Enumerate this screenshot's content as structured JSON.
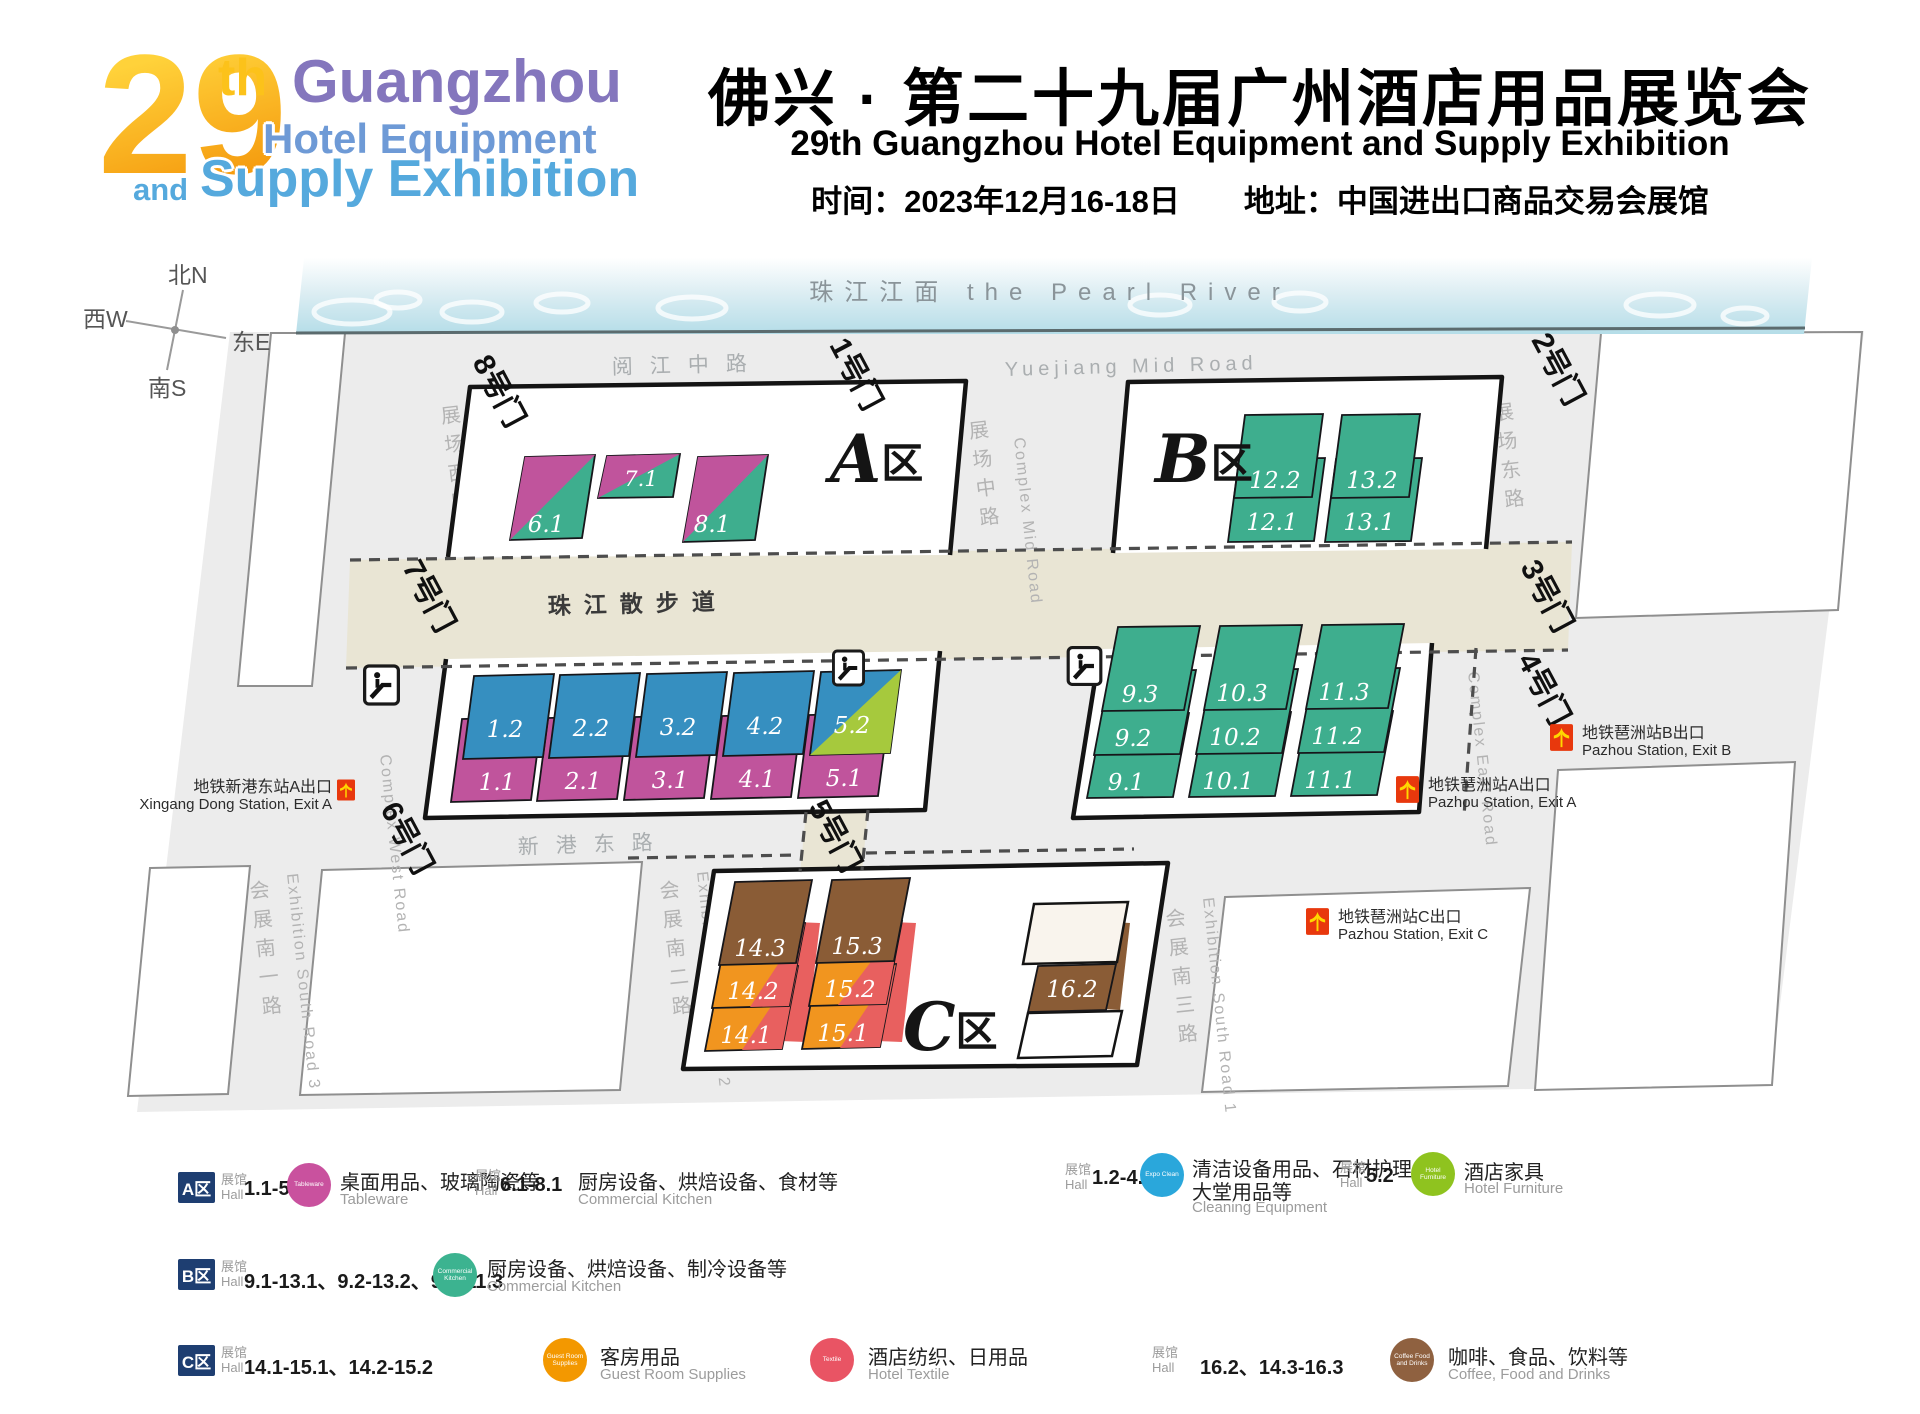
{
  "header": {
    "logo_29": "29",
    "logo_th": "th",
    "logo_l1": "Guangzhou",
    "logo_l2": "Hotel Equipment",
    "logo_and": "and",
    "logo_l3": "Supply Exhibition",
    "title_cn": "佛兴 · 第二十九届广州酒店用品展览会",
    "title_en": "29th Guangzhou Hotel Equipment and Supply Exhibition",
    "time_label": "时间：2023年12月16-18日",
    "addr_label": "地址：中国进出口商品交易会展馆"
  },
  "compass": {
    "n": "北N",
    "w": "西W",
    "e": "东E",
    "s": "南S"
  },
  "map": {
    "river": "珠江江面 the Pearl River",
    "roads": {
      "yuejiang_cn": "阅江中路",
      "yuejiang_en": "Yuejiang Mid Road",
      "promenade": "珠江散步道",
      "xingang": "新港东路",
      "complex_west_cn": "展场西路",
      "complex_west_en": "Complex West Road",
      "complex_mid_cn": "展场中路",
      "complex_mid_en": "Complex Mid Road",
      "complex_east_cn": "展场东路",
      "complex_east_en": "Complex East Road",
      "south1_cn": "会展南一路",
      "south1_en": "Exhibition South Road 3",
      "south2_cn": "会展南二路",
      "south2_en": "Exhibition South Road 2",
      "south3_cn": "会展南三路",
      "south3_en": "Exhibition South Road 1"
    },
    "gates": {
      "g1": "1号门",
      "g2": "2号门",
      "g3": "3号门",
      "g4": "4号门",
      "g5": "5号门",
      "g6": "6号门",
      "g7": "7号门",
      "g8": "8号门"
    },
    "zones": {
      "a": "A",
      "b": "B",
      "c": "C",
      "qu": "区"
    },
    "halls": {
      "h1_1": "1.1",
      "h2_1": "2.1",
      "h3_1": "3.1",
      "h4_1": "4.1",
      "h5_1": "5.1",
      "h1_2": "1.2",
      "h2_2": "2.2",
      "h3_2": "3.2",
      "h4_2": "4.2",
      "h5_2": "5.2",
      "h6_1": "6.1",
      "h7_1": "7.1",
      "h8_1": "8.1",
      "h9_1": "9.1",
      "h9_2": "9.2",
      "h9_3": "9.3",
      "h10_1": "10.1",
      "h10_2": "10.2",
      "h10_3": "10.3",
      "h11_1": "11.1",
      "h11_2": "11.2",
      "h11_3": "11.3",
      "h12_1": "12.1",
      "h12_2": "12.2",
      "h13_1": "13.1",
      "h13_2": "13.2",
      "h14_1": "14.1",
      "h14_2": "14.2",
      "h14_3": "14.3",
      "h15_1": "15.1",
      "h15_2": "15.2",
      "h15_3": "15.3",
      "h16_2": "16.2"
    },
    "metro": {
      "xingang_cn": "地铁新港东站A出口",
      "xingang_en": "Xingang Dong Station, Exit A",
      "pzb_cn": "地铁琶洲站B出口",
      "pzb_en": "Pazhou Station, Exit B",
      "pza_cn": "地铁琶洲站A出口",
      "pza_en": "Pazhou Station, Exit A",
      "pzc_cn": "地铁琶洲站C出口",
      "pzc_en": "Pazhou Station, Exit C"
    }
  },
  "legend": {
    "hall_cn": "展馆",
    "hall_en": "Hall",
    "a": {
      "badge": "A区",
      "e1_halls": "1.1-5.1",
      "e1_icon": "Tableware",
      "e1_cn": "桌面用品、玻璃陶瓷等",
      "e1_en": "Tableware",
      "e2_halls": "6.1-8.1",
      "e2_cn": "厨房设备、烘焙设备、食材等",
      "e2_en": "Commercial Kitchen",
      "e3_halls": "1.2-4.2",
      "e3_icon": "Expo Clean",
      "e3_cn1": "清洁设备用品、石材护理、",
      "e3_cn2": "大堂用品等",
      "e3_en": "Cleaning Equipment",
      "e4_halls": "5.2",
      "e4_icon": "Hotel Furniture",
      "e4_cn": "酒店家具",
      "e4_en": "Hotel Furniture"
    },
    "b": {
      "badge": "B区",
      "e1_halls": "9.1-13.1、9.2-13.2、9.3-11.3",
      "e1_icon": "Commercial Kitchen",
      "e1_cn": "厨房设备、烘焙设备、制冷设备等",
      "e1_en": "Commercial Kitchen"
    },
    "c": {
      "badge": "C区",
      "e1_halls": "14.1-15.1、14.2-15.2",
      "e1_icon": "Guest Room Supplies",
      "e1_cn": "客房用品",
      "e1_en": "Guest Room Supplies",
      "e2_icon": "Textile",
      "e2_cn": "酒店纺织、日用品",
      "e2_en": "Hotel Textile",
      "e3_halls": "16.2、14.3-16.3",
      "e3_icon": "Coffee Food and Drinks",
      "e3_cn": "咖啡、食品、饮料等",
      "e3_en": "Coffee, Food and Drinks"
    }
  },
  "colors": {
    "magenta": "#c0549c",
    "blue": "#368fc0",
    "green": "#3eae8e",
    "lime": "#a6c93d",
    "brown": "#8a5c36",
    "orange": "#f1951f",
    "red": "#e8605f",
    "badge_navy": "#1e3e71",
    "walkway_beige": "#e9e5d4",
    "metro_red": "#e8380d",
    "metro_yellow": "#ffd800"
  }
}
